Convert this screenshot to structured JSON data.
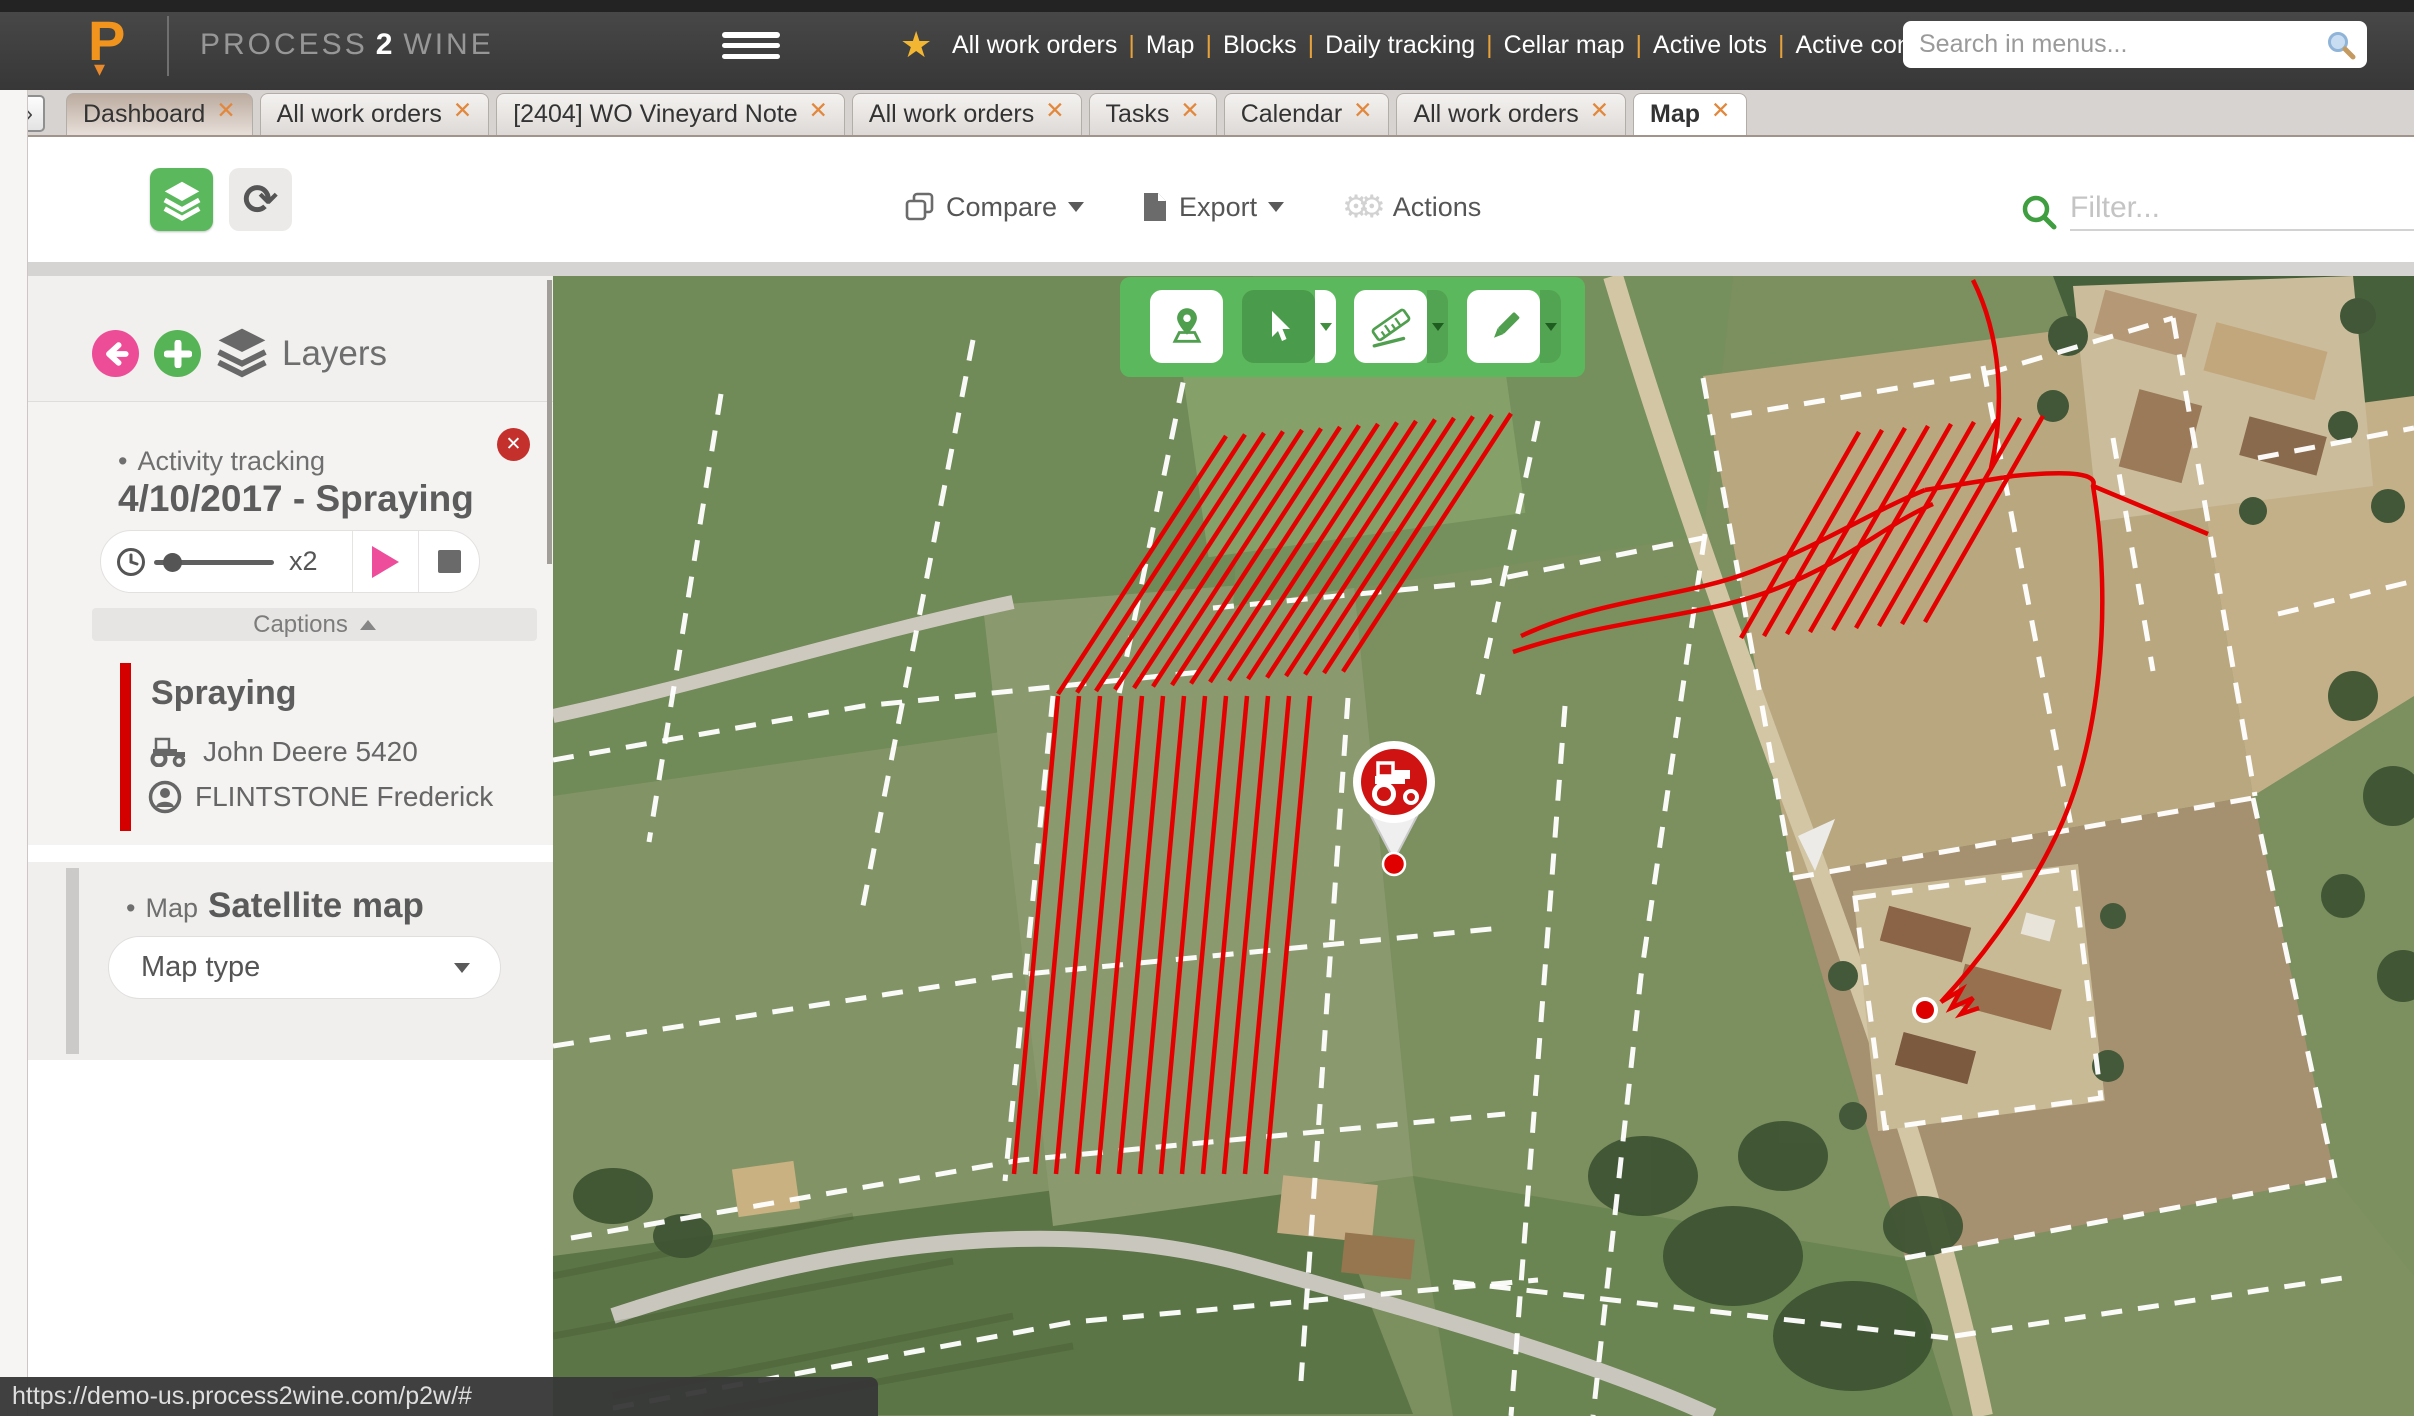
{
  "topbar": {
    "logo_letter": "P",
    "brand_parts": {
      "p1": "PROCESS",
      "p2": "2",
      "p3": "WINE"
    },
    "star_glyph": "★",
    "menu_items": [
      "All work orders",
      "Map",
      "Blocks",
      "Daily tracking",
      "Cellar map",
      "Active lots",
      "Active containers",
      "Calendar",
      "Winery and wine"
    ],
    "menu_separator": "|",
    "search_placeholder": "Search in menus..."
  },
  "tab_bar": {
    "expander_glyph": "»",
    "close_glyph": "✕",
    "tabs": [
      {
        "label": "Dashboard",
        "style": "dashboard"
      },
      {
        "label": "All work orders",
        "style": ""
      },
      {
        "label": "[2404] WO Vineyard Note",
        "style": ""
      },
      {
        "label": "All work orders",
        "style": ""
      },
      {
        "label": "Tasks",
        "style": ""
      },
      {
        "label": "Calendar",
        "style": ""
      },
      {
        "label": "All work orders",
        "style": ""
      },
      {
        "label": "Map",
        "style": "active"
      }
    ]
  },
  "toolbar": {
    "refresh_glyph": "⟳",
    "compare_label": "Compare",
    "export_label": "Export",
    "actions_label": "Actions",
    "gears_glyph": "⚙⚙",
    "filter_placeholder": "Filter..."
  },
  "layers_panel": {
    "title": "Layers",
    "bullet": "•",
    "activity_section": {
      "label": "Activity tracking",
      "heading": "4/10/2017 - Spraying",
      "speed_label": "x2",
      "captions_label": "Captions",
      "caption": {
        "title": "Spraying",
        "machine": "John Deere 5420",
        "operator": "FLINTSTONE Frederick"
      }
    },
    "map_section": {
      "label": "Map",
      "heading": "Satellite map",
      "dropdown_label": "Map type"
    },
    "close_glyph": "✕",
    "plus_glyph": "+"
  },
  "status_bar": {
    "url": "https://demo-us.process2wine.com/p2w/#"
  },
  "colors": {
    "green": "#5cb85c",
    "dark_green": "#4a9b4c",
    "pink": "#ec4d96",
    "red": "#dd0000",
    "orange": "#e8923a"
  }
}
